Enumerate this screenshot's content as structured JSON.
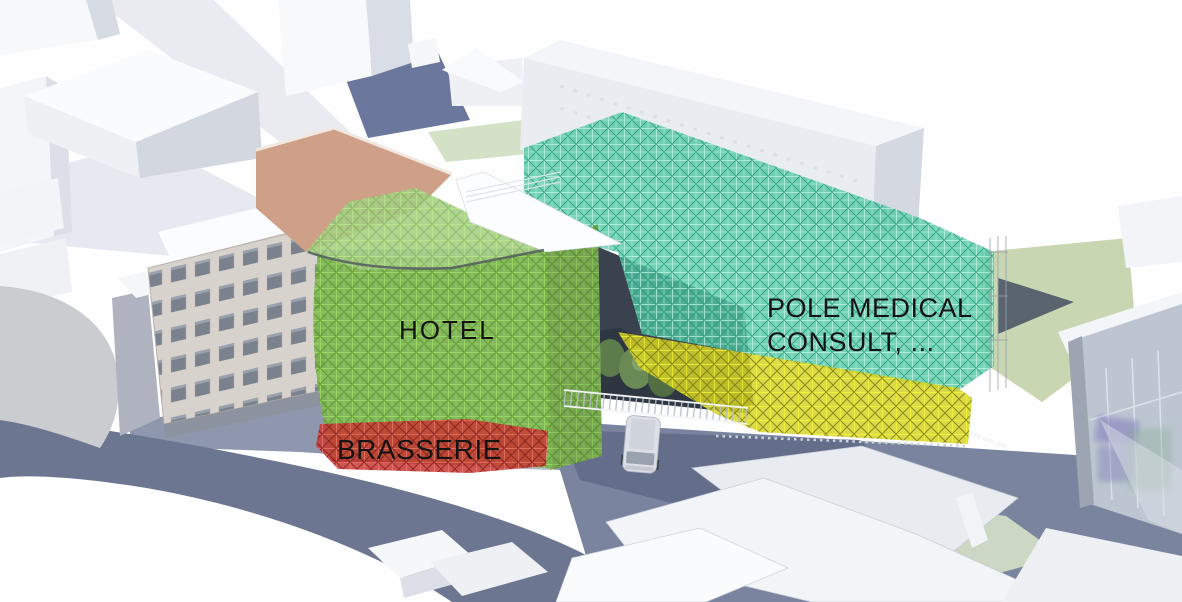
{
  "scene": {
    "description": "3D architectural massing render with colored program-zone overlays"
  },
  "labels": {
    "hotel": "HOTEL",
    "brasserie": "BRASSERIE",
    "pole_line1": "POLE MEDICAL",
    "pole_line2": "CONSULT, ..."
  },
  "palette": {
    "hotel_green": "#77b545",
    "brasserie_red": "#c93833",
    "medical_teal": "#53c7a4",
    "annex_yellow": "#d6d428",
    "label_ink": "#141414"
  }
}
